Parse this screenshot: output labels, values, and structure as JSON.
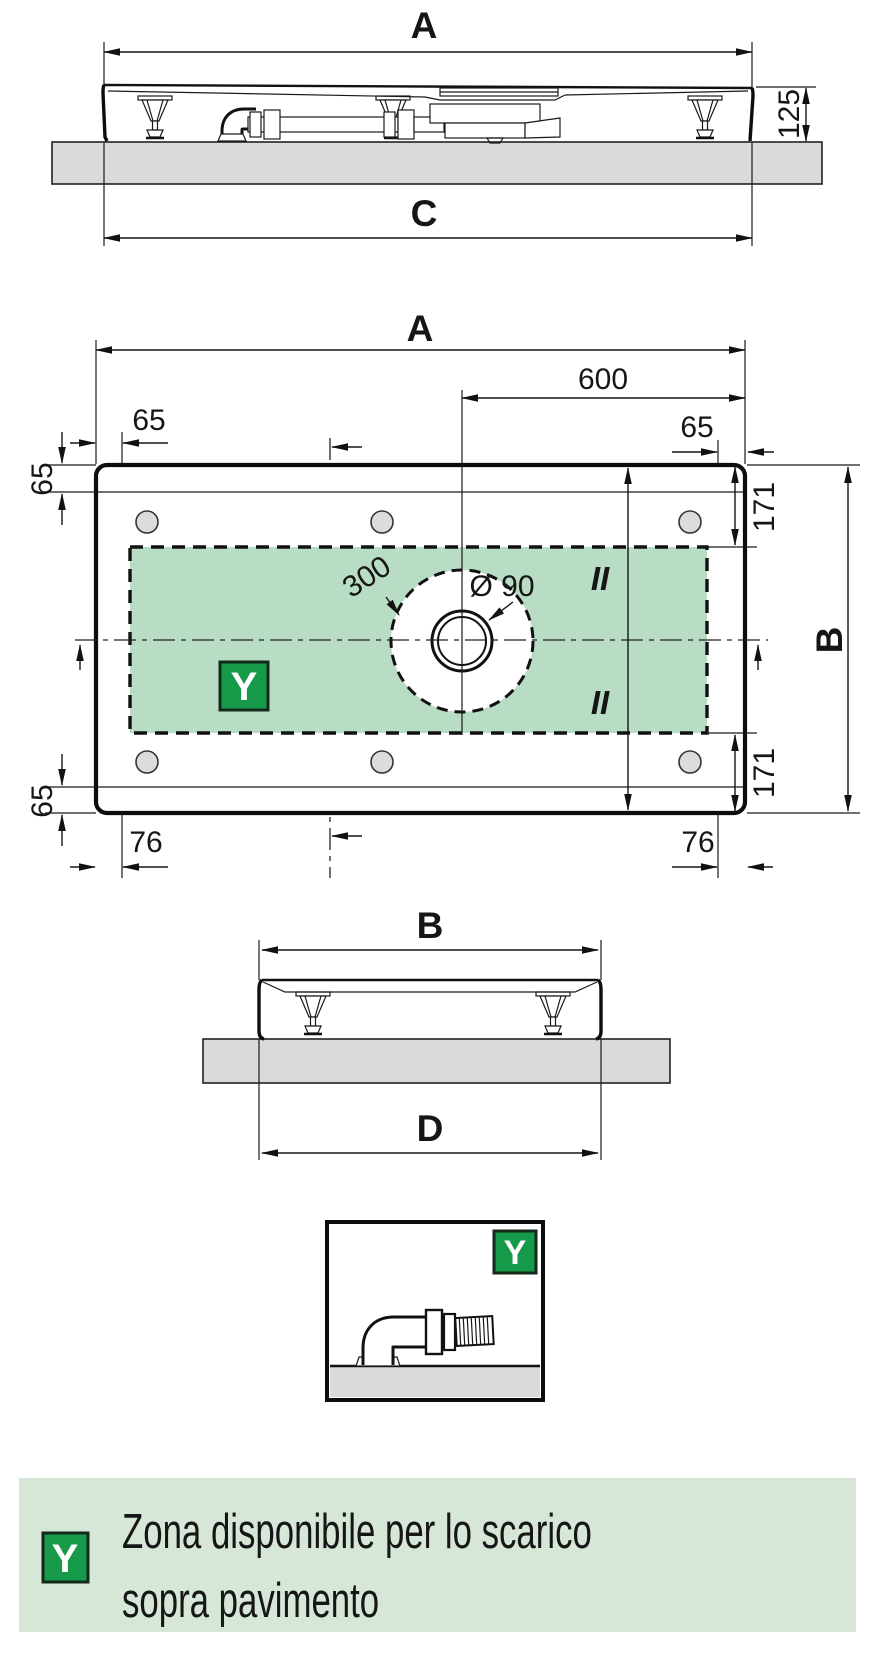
{
  "colors": {
    "zone_fill": "#b9dcc5",
    "legend_bg": "#d6e7d8",
    "badge_green": "#169a49",
    "slab_gray": "#dadada"
  },
  "side_view_front": {
    "width_label": "A",
    "height_label": "125",
    "floor_width_label": "C"
  },
  "plan_view": {
    "width_label": "A",
    "drain_offset": "600",
    "edge_offset_left": "65",
    "edge_offset_right": "65",
    "rim_offset_top_left": "65",
    "rim_offset_bottom_left": "65",
    "zone_offset_top": "171",
    "zone_offset_bottom": "171",
    "depth_label": "B",
    "foot_offset_left": "76",
    "foot_offset_right": "76",
    "clearance_circle": "300",
    "drain_diameter": "Ø 90",
    "equal_top": "II",
    "equal_bottom": "II",
    "zone_badge": "Y"
  },
  "side_view_end": {
    "width_label": "B",
    "floor_width_label": "D"
  },
  "detail_box": {
    "badge": "Y"
  },
  "legend": {
    "badge": "Y",
    "line1": "Zona disponibile per lo scarico",
    "line2": "sopra pavimento"
  }
}
